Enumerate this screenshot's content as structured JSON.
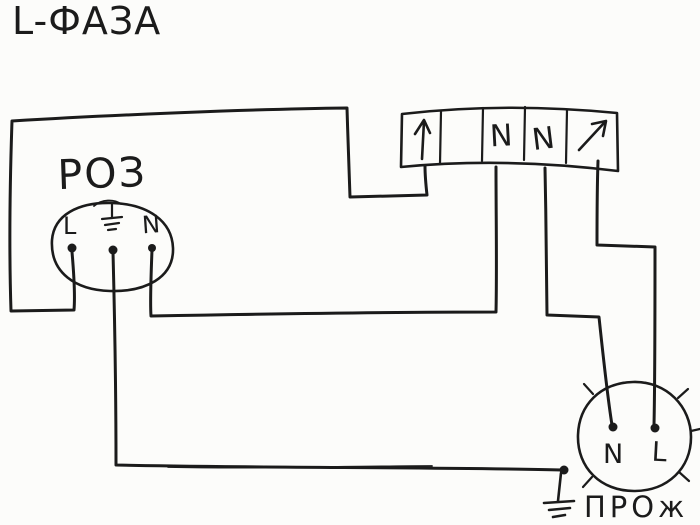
{
  "diagram": {
    "phase_label": "L-ФАЗА",
    "socket": {
      "title": "РОЗ",
      "terminal_left": "L",
      "terminal_middle_icon": "earth-ground",
      "terminal_right": "N"
    },
    "terminal_block": {
      "cells": [
        {
          "type": "arrow-up",
          "label": ""
        },
        {
          "type": "empty",
          "label": ""
        },
        {
          "type": "neutral",
          "label": "N"
        },
        {
          "type": "neutral",
          "label": "N"
        },
        {
          "type": "arrow-diagonal",
          "label": ""
        }
      ]
    },
    "floodlight": {
      "title": "ПРОж",
      "terminal_left": "N",
      "terminal_right": "L"
    },
    "colors": {
      "ink": "#1b1b1b",
      "paper": "#fcfcfa"
    }
  }
}
